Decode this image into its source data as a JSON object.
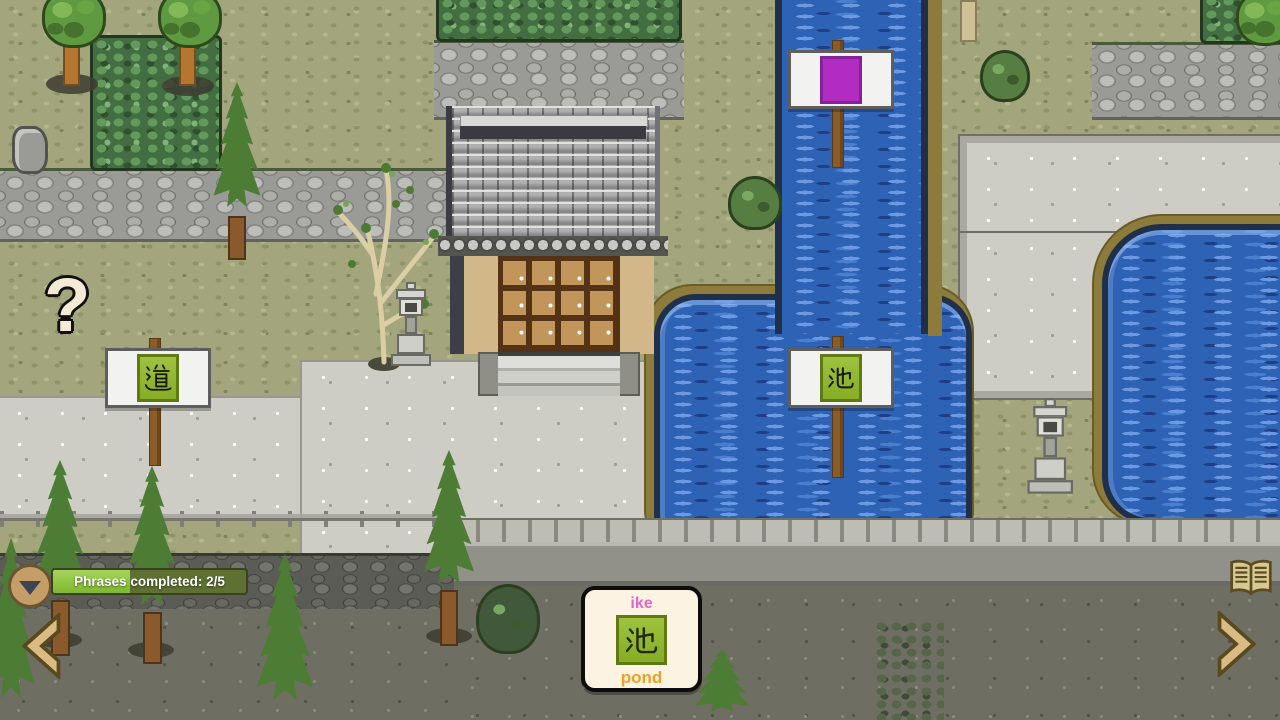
{
  "hud": {
    "progress": {
      "label": "Phrases completed: 2/5",
      "completed": 2,
      "total": 5
    },
    "word_card": {
      "reading": "ike",
      "kanji": "池",
      "meaning": "pond"
    },
    "icons": {
      "collapse": "chevron-down",
      "prev": "chevron-left",
      "next": "chevron-right",
      "phrasebook": "open-book"
    }
  },
  "world": {
    "question_mark": "?",
    "signs": {
      "road": {
        "kanji": "道"
      },
      "pond": {
        "kanji": "池"
      },
      "locked": {
        "symbol": "purple-square"
      }
    }
  },
  "colors": {
    "progress_fill": "#8cc63d",
    "progress_track": "#5e7132",
    "reading_pink": "#e666c8",
    "meaning_orange": "#e9a32b",
    "kanji_tile_green": "#8fb832",
    "locked_purple": "#b32cc1",
    "water_blue": "#2e62b4",
    "nav_arrow_tan": "#d9bb83",
    "card_cream": "#fcf3e2"
  }
}
